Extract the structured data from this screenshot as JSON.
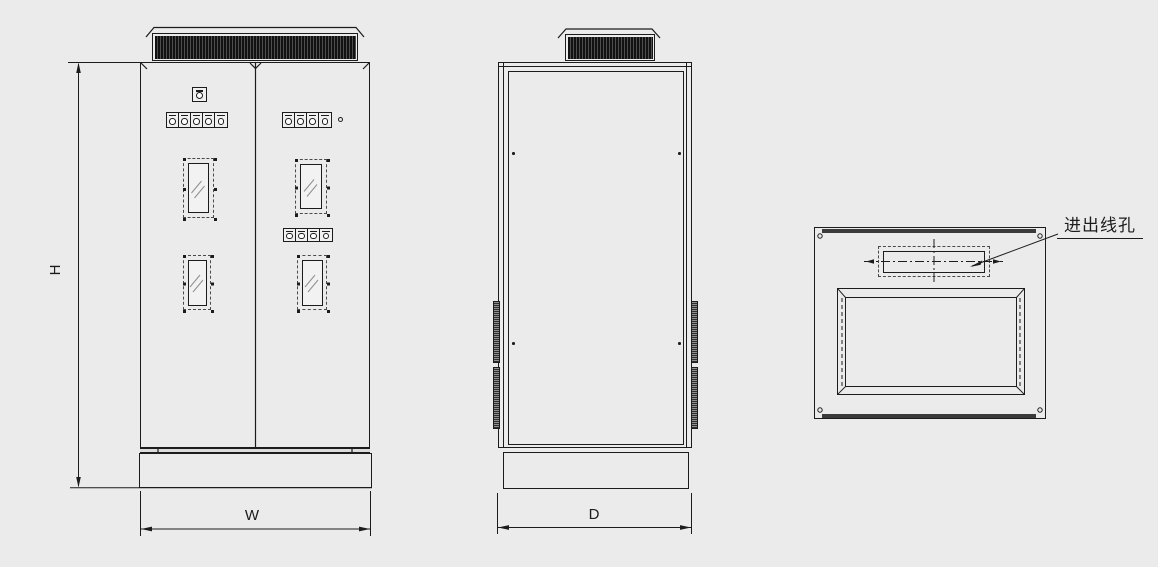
{
  "diagram": {
    "labels": {
      "height": "H",
      "width": "W",
      "depth": "D",
      "cable_hole": "进出线孔"
    },
    "colors": {
      "background": "#ebebeb",
      "line": "#1c1c1c",
      "louver_dark": "#121212"
    },
    "front_view": {
      "indicator_rows": [
        {
          "count": 5
        },
        {
          "count": 4
        },
        {
          "count": 4
        }
      ],
      "window_count": 4
    },
    "side_view": {
      "hinge_strip_count": 4
    },
    "top_view": {
      "corner_screw_count": 4
    }
  }
}
